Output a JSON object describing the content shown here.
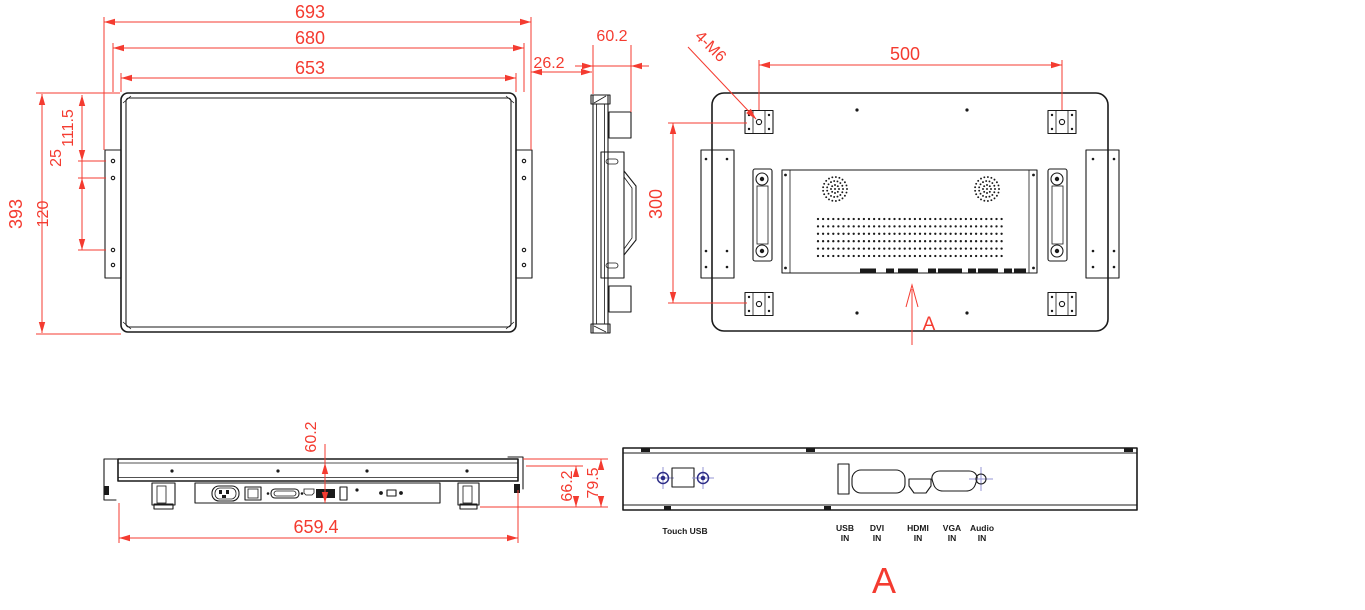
{
  "colors": {
    "dimension_red": "#f43b30",
    "drawing_line": "#1a1a1a",
    "screw_navy": "#2d2d86",
    "screw_light_blue": "#9494d6"
  },
  "front": {
    "dim_width_overall": "693",
    "dim_width_frame": "680",
    "dim_width_panel": "653",
    "dim_height": "393",
    "dim_hole_top_offset": "111.5",
    "dim_hole_gap": "25",
    "dim_hole_pitch": "120",
    "dim_bracket_offset": "26.2"
  },
  "side": {
    "dim_depth": "60.2"
  },
  "rear": {
    "label_vesa_screws": "4-M6",
    "dim_vesa_width": "500",
    "dim_vesa_height": "300",
    "section_arrow_label": "A"
  },
  "bottom": {
    "dim_depth": "60.2",
    "dim_width": "659.4",
    "dim_height_body": "66.2",
    "dim_height_overall": "79.5"
  },
  "detail": {
    "view_label": "A",
    "touch_port_label": "Touch USB",
    "ports": [
      {
        "name": "USB",
        "dir": "IN"
      },
      {
        "name": "DVI",
        "dir": "IN"
      },
      {
        "name": "HDMI",
        "dir": "IN"
      },
      {
        "name": "VGA",
        "dir": "IN"
      },
      {
        "name": "Audio",
        "dir": "IN"
      }
    ]
  }
}
